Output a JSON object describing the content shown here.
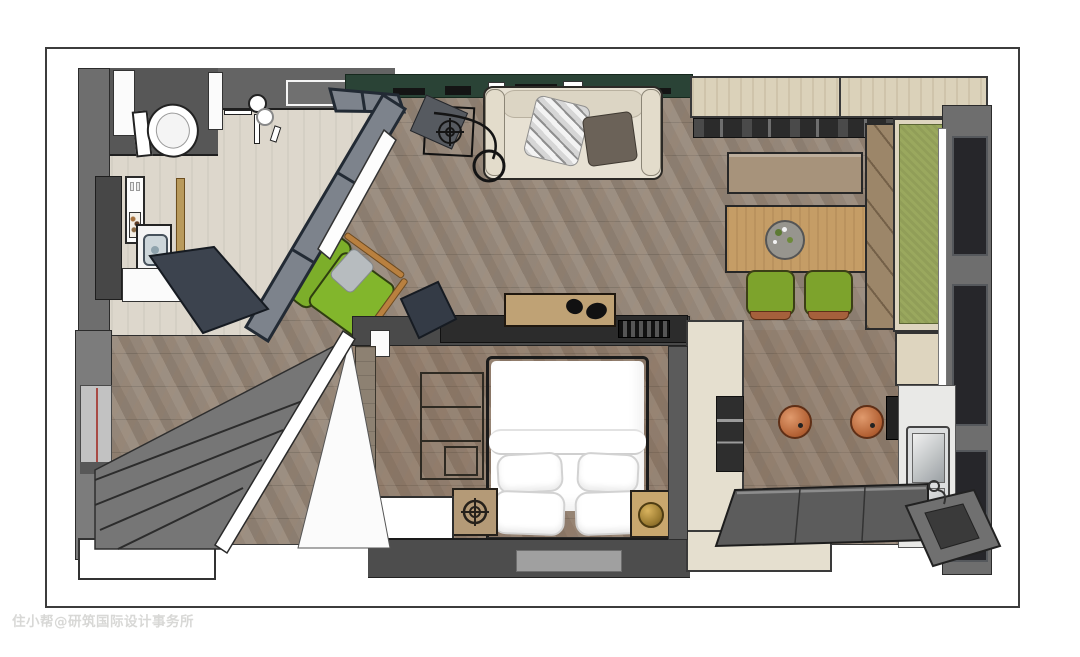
{
  "meta": {
    "title": "apartment-3d-floor-plan",
    "view": "top-down-3d-rendering"
  },
  "watermark": {
    "text": "住小帮@研筑国际设计事务所"
  },
  "colors": {
    "page_bg": "#ffffff",
    "border": "#3c3c3c",
    "watermark": "#d8d8d6",
    "wall_gray": "#757575",
    "wall_gray_dark": "#5a5a5a",
    "wall_near_black": "#2e2e2e",
    "accent_wall_green": "#2a4336",
    "floor_wood": "#9a8b7c",
    "floor_bath": "#ddd7cc",
    "glass_frame": "#222a34",
    "glass_pane": "#7d838c",
    "door_slate": "#3c434e",
    "sofa_cream": "#e7e1d3",
    "cushion_dark": "#6b6258",
    "chair_green": "#82b62c",
    "bench_olive": "#9aa85e",
    "wood_table": "#c59d66",
    "wood_bench": "#a7937b",
    "wood_light_cabinet": "#dbd2ba",
    "wood_headboard": "#bfa275",
    "wood_nightstand": "#b49a77",
    "copper": "#b8663a",
    "brass": "#c3a155",
    "counter_dark": "#5c5c5c",
    "counter_white": "#e9e9e7",
    "steel": "#c6cacc"
  },
  "rooms": [
    {
      "id": "bathroom",
      "furniture": [
        "toilet",
        "shower",
        "vanity-mirror",
        "wall-sink",
        "washing-machine",
        "storage-cabinet",
        "shelf-with-toiletries",
        "towel-ladder",
        "glass-partition",
        "door-leaf"
      ]
    },
    {
      "id": "living-room",
      "furniture": [
        "sofa",
        "throw-blanket",
        "accent-cushion",
        "arc-floor-lamp",
        "side-table",
        "green-lounge-chair",
        "green-accent-wall",
        "wall-decor"
      ]
    },
    {
      "id": "dining-area",
      "furniture": [
        "dining-table",
        "flower-planter",
        "dining-chair",
        "dining-chair",
        "dining-bench",
        "window-seat-bench",
        "overhead-cabinets",
        "display-shelf"
      ]
    },
    {
      "id": "kitchen",
      "furniture": [
        "l-shaped-counter",
        "built-in-appliance",
        "kitchen-sink",
        "faucet",
        "copper-pendant-lamp",
        "copper-pendant-lamp",
        "small-appliance",
        "dark-counter"
      ]
    },
    {
      "id": "bedroom",
      "furniture": [
        "double-bed",
        "pillow",
        "pillow",
        "pillow",
        "pillow",
        "headboard-shelf",
        "open-shelf-unit",
        "nightstand-left",
        "nightstand-right",
        "brass-table-lamp",
        "white-dresser",
        "rug",
        "radiator-grille"
      ]
    },
    {
      "id": "entry-hall",
      "furniture": [
        "staircase",
        "stair-railing",
        "wall-niche",
        "open-door-leaf",
        "landing-box"
      ]
    }
  ],
  "windows": {
    "count": 3,
    "position": "right-wall"
  }
}
